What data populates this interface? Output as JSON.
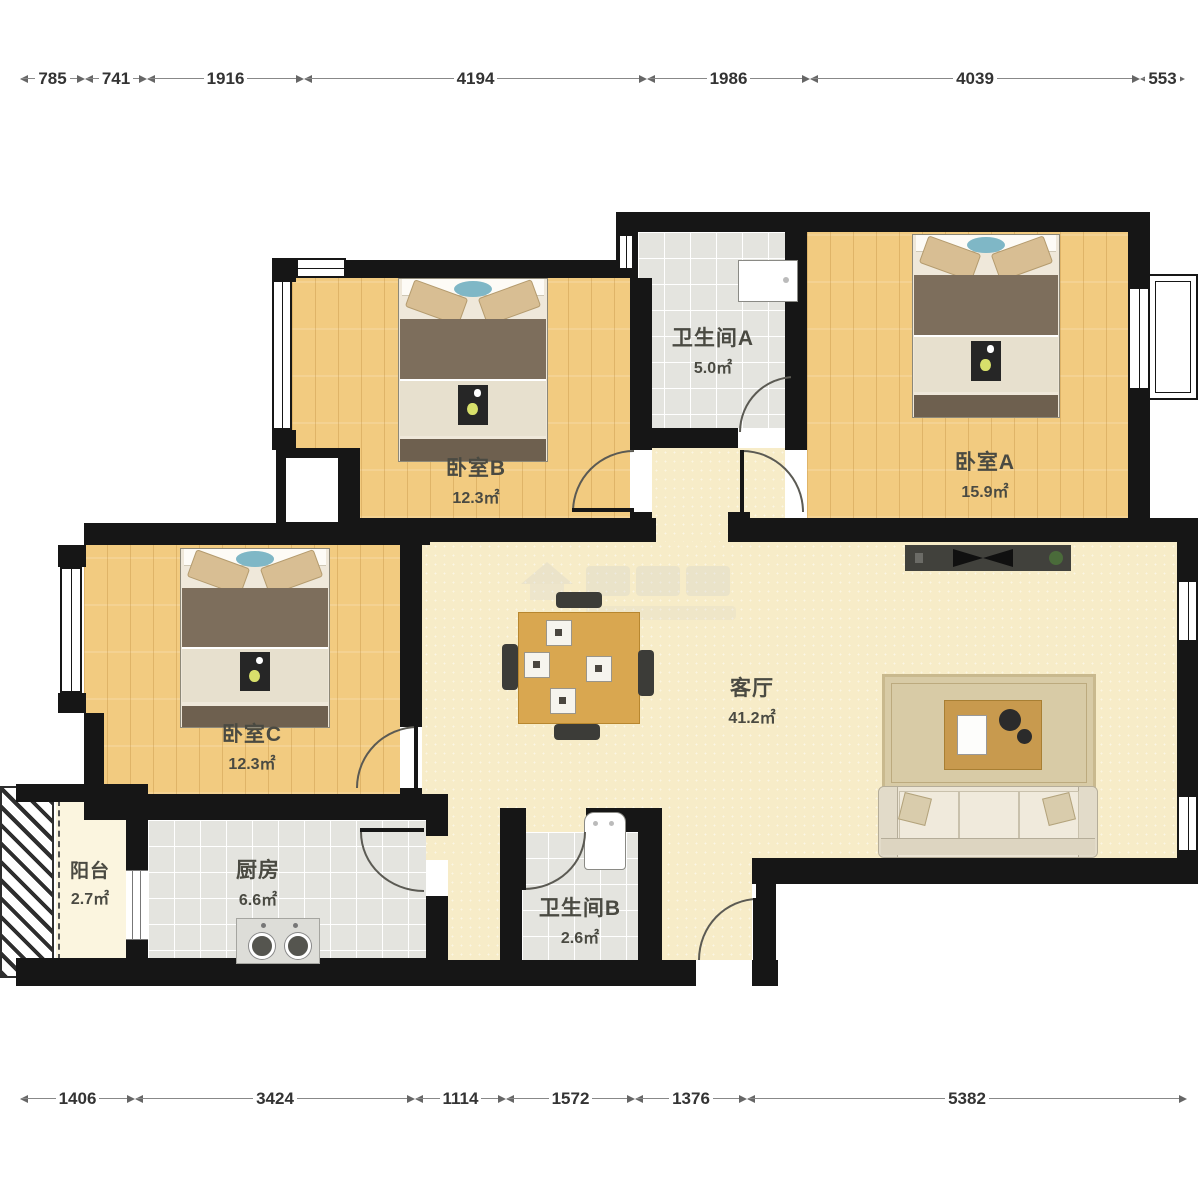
{
  "plan": {
    "rooms": {
      "bathroomA": {
        "name": "卫生间A",
        "area": "5.0㎡"
      },
      "bedroomA": {
        "name": "卧室A",
        "area": "15.9㎡"
      },
      "bedroomB": {
        "name": "卧室B",
        "area": "12.3㎡"
      },
      "bedroomC": {
        "name": "卧室C",
        "area": "12.3㎡"
      },
      "living": {
        "name": "客厅",
        "area": "41.2㎡"
      },
      "kitchen": {
        "name": "厨房",
        "area": "6.6㎡"
      },
      "bathroomB": {
        "name": "卫生间B",
        "area": "2.6㎡"
      },
      "balcony": {
        "name": "阳台",
        "area": "2.7㎡"
      }
    },
    "dimensions": {
      "top": [
        "785",
        "741",
        "1916",
        "4194",
        "1986",
        "4039",
        "553"
      ],
      "bottom": [
        "1406",
        "3424",
        "1114",
        "1572",
        "1376",
        "5382"
      ]
    },
    "colors": {
      "wall": "#161616",
      "wood_floor": "#F2CB80",
      "living_floor": "#F7ECC8",
      "tile_floor": "#E4E4DF",
      "balcony_floor": "#FBF5DF",
      "dimension_text": "#333333",
      "label_text": "#4a4a42",
      "bed_blanket": "#7D6E5C",
      "table_wood": "#D9A750"
    }
  }
}
